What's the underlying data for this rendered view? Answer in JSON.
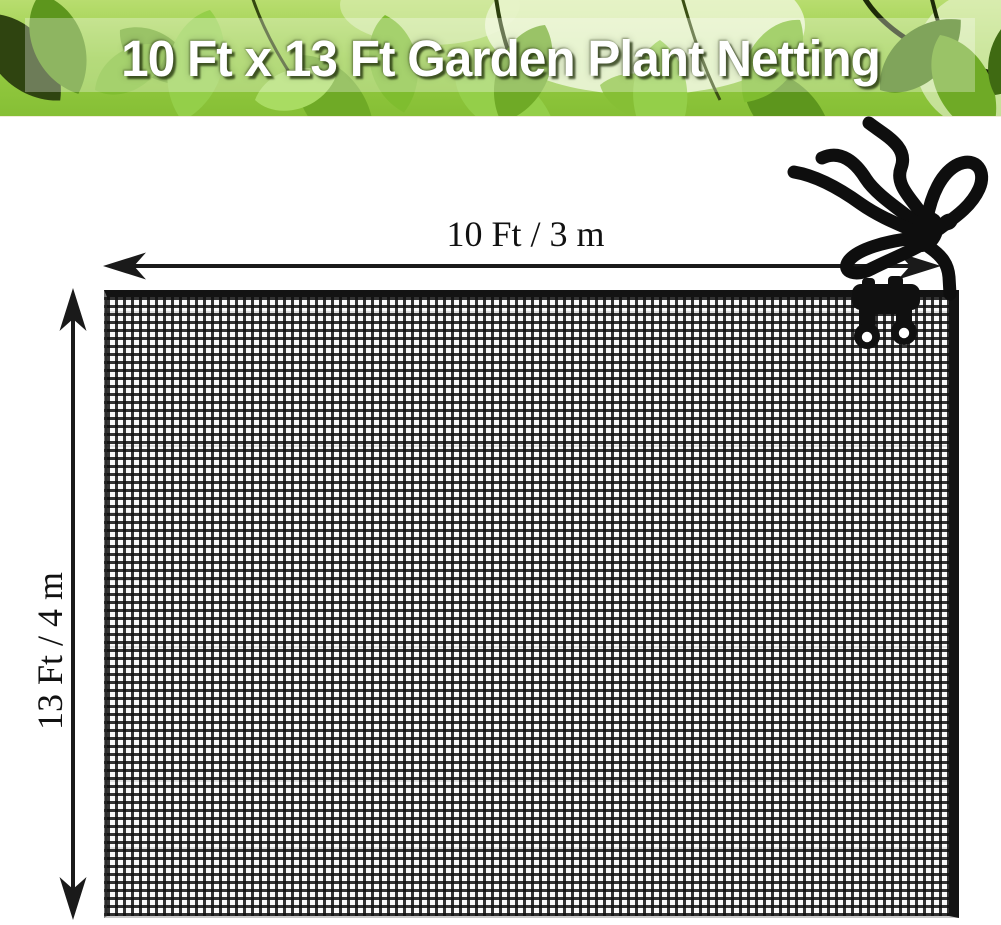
{
  "banner": {
    "title": "10 Ft x 13 Ft Garden Plant Netting",
    "text_color": "#ffffff",
    "background_greens": [
      "#b8dd6f",
      "#96cc43",
      "#6faa26",
      "#5d961d"
    ]
  },
  "diagram": {
    "width_label": "10 Ft / 3 m",
    "height_label": "13 Ft / 4 m",
    "arrow_color": "#1a1a1a",
    "label_color": "#111111",
    "background": "#ffffff"
  },
  "product": {
    "net_color": "#131313",
    "mesh_background": "#fafafa",
    "mesh_cell_px": 8,
    "accessories": [
      "drawstring-cord-with-toggle",
      "two-edge-clips"
    ]
  }
}
